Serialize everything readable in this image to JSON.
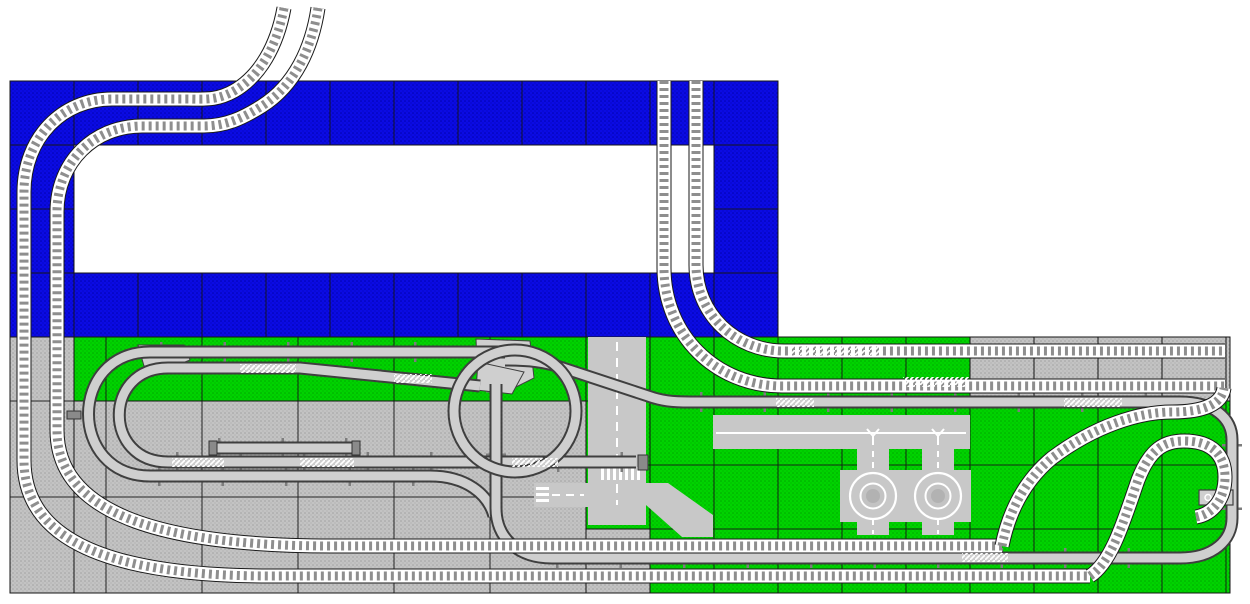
{
  "canvas": {
    "width": 1250,
    "height": 604,
    "background": "#ffffff"
  },
  "palette": {
    "baseplate_blue": "#0b0be4",
    "baseplate_blue_dot": "#0000a8",
    "baseplate_green": "#00d300",
    "baseplate_green_dot": "#00a300",
    "baseplate_gray": "#c3c3c3",
    "baseplate_gray_dot": "#9f9f9f",
    "road_gray": "#c8c8c8",
    "grid_line": "#151515",
    "rail_outline": "#1a1a1a",
    "rail_bed": "#ffffff",
    "rail_tie": "#8e8e8e",
    "mono_outline": "#3f3f3f",
    "mono_fill": "#cfcfcf",
    "mono_support": "#7d7d7d",
    "mono_cap": "#8a8a8a",
    "marking_white": "#ffffff"
  },
  "plates": [
    {
      "name": "blue-frame-top",
      "fill": "blue",
      "x": 10,
      "y": 81,
      "w": 768,
      "h": 64,
      "grid": {
        "ox": 10,
        "oy": 81,
        "cw": 64,
        "ch": 64
      }
    },
    {
      "name": "blue-frame-bottom",
      "fill": "blue",
      "x": 10,
      "y": 273,
      "w": 768,
      "h": 64,
      "grid": {
        "ox": 10,
        "oy": 81,
        "cw": 64,
        "ch": 64
      }
    },
    {
      "name": "blue-frame-left",
      "fill": "blue",
      "x": 10,
      "y": 145,
      "w": 64,
      "h": 128,
      "grid": {
        "ox": 10,
        "oy": 81,
        "cw": 64,
        "ch": 64
      }
    },
    {
      "name": "blue-frame-right",
      "fill": "blue",
      "x": 714,
      "y": 145,
      "w": 64,
      "h": 128,
      "grid": {
        "ox": 10,
        "oy": 81,
        "cw": 64,
        "ch": 64
      }
    },
    {
      "name": "green-band",
      "fill": "green",
      "x": 74,
      "y": 337,
      "w": 512,
      "h": 64,
      "grid": {
        "ox": 10,
        "oy": 337,
        "cw": 96,
        "ch": 96
      }
    },
    {
      "name": "road-column-plate",
      "fill": "green",
      "x": 586,
      "y": 337,
      "w": 64,
      "h": 192,
      "grid": {
        "ox": 586,
        "oy": 337,
        "cw": 64,
        "ch": 64
      }
    },
    {
      "name": "green-right",
      "fill": "green",
      "x": 650,
      "y": 337,
      "w": 580,
      "h": 256,
      "grid": {
        "ox": 650,
        "oy": 337,
        "cw": 64,
        "ch": 64
      }
    },
    {
      "name": "gray-left-column",
      "fill": "gray",
      "x": 10,
      "y": 337,
      "w": 64,
      "h": 256,
      "grid": {
        "ox": 10,
        "oy": 401,
        "cw": 96,
        "ch": 96
      }
    },
    {
      "name": "gray-main",
      "fill": "gray",
      "x": 74,
      "y": 401,
      "w": 512,
      "h": 192,
      "grid": {
        "ox": 10,
        "oy": 401,
        "cw": 96,
        "ch": 96
      }
    },
    {
      "name": "gray-under-road",
      "fill": "gray",
      "x": 586,
      "y": 529,
      "w": 64,
      "h": 64,
      "grid": {
        "ox": 586,
        "oy": 529,
        "cw": 64,
        "ch": 64
      }
    },
    {
      "name": "gray-top-right",
      "fill": "gray",
      "x": 970,
      "y": 337,
      "w": 260,
      "h": 64,
      "grid": {
        "ox": 970,
        "oy": 337,
        "cw": 64,
        "ch": 64
      }
    }
  ],
  "roads": {
    "rects": [
      {
        "name": "road-vertical-strip",
        "x": 588,
        "y": 337,
        "w": 58,
        "h": 188
      },
      {
        "name": "road-west-stub",
        "x": 534,
        "y": 483,
        "w": 58,
        "h": 24
      },
      {
        "name": "road-green-band",
        "x": 713,
        "y": 415,
        "w": 257,
        "h": 34
      }
    ],
    "polygons": [
      {
        "name": "road-diagonal",
        "points": "646,483 668,483 713,515 713,537 682,537 646,505"
      }
    ],
    "roundabouts": {
      "centers": [
        [
          873,
          496
        ],
        [
          938,
          496
        ]
      ],
      "arm_v": {
        "w": 32,
        "y": 449,
        "h": 86
      },
      "arm_h": {
        "w": 66,
        "y": 470,
        "h": 52
      },
      "disc_r": 28,
      "outer_ring_r": 23,
      "inner_ring_r": 12.5,
      "hub_r": 7
    },
    "crosswalks": [
      {
        "name": "crosswalk-vertical-road",
        "x": 600,
        "y": 467,
        "w": 42,
        "h": 13,
        "pattern": "zebraV"
      },
      {
        "name": "crosswalk-west-stub",
        "x": 536,
        "y": 485,
        "w": 13,
        "h": 20,
        "pattern": "zebraH"
      }
    ],
    "lines": [
      {
        "name": "centerline-v",
        "d": "M617,342 L617,464",
        "dash": "9 7"
      },
      {
        "name": "centerline-v-lower",
        "d": "M617,484 L617,505",
        "dash": "9 7"
      },
      {
        "name": "centerline-stub",
        "d": "M552,495 L584,495",
        "dash": "8 6"
      },
      {
        "name": "centerline-greenband",
        "d": "M716,433 L966,433",
        "dash": ""
      },
      {
        "name": "roundabout1-dash-up",
        "d": "M873,451 L873,474",
        "dash": "6 5"
      },
      {
        "name": "roundabout1-dash-down",
        "d": "M873,519 L873,534",
        "dash": "6 5"
      },
      {
        "name": "roundabout2-dash-up",
        "d": "M938,451 L938,474",
        "dash": "6 5"
      },
      {
        "name": "roundabout2-dash-down",
        "d": "M938,519 L938,534",
        "dash": "6 5"
      }
    ],
    "y_arrows": [
      [
        873,
        429
      ],
      [
        938,
        429
      ]
    ]
  },
  "monorail": {
    "lines": [
      {
        "name": "monorail-oval-outer",
        "d": "M505,352 L150,352 C68,352 68,476 150,476 L430,476 C466,476 488,494 494,516"
      },
      {
        "name": "monorail-oval-inner",
        "d": "M480,386 L300,368 L168,368 C103,368 103,462 168,462 L636,462"
      },
      {
        "name": "monorail-siding",
        "d": "M212,448 L358,448"
      },
      {
        "name": "monorail-main-loop",
        "d": "M505,360 C530,360 545,362 560,367 L648,396 C662,401 672,402 690,402 L1180,402 C1214,402 1232,418 1232,440 L1232,518 C1232,540 1214,558 1180,558 L552,558 C518,558 496,538 496,508 L496,384"
      }
    ],
    "circle": {
      "cx": 515,
      "cy": 411,
      "r": 61
    },
    "switches": [
      {
        "name": "monorail-switch-west",
        "points": "138,345 184,345 190,360 170,368 144,366"
      },
      {
        "name": "monorail-switch-north-a",
        "points": "476,339 530,341 534,378 510,390 478,386"
      },
      {
        "name": "monorail-switch-north-b",
        "points": "478,362 524,372 512,394 476,390"
      }
    ],
    "supports": [
      [
        160,
        352,
        498,
        352
      ],
      [
        176,
        462,
        630,
        462
      ],
      [
        158,
        476,
        425,
        476
      ],
      [
        218,
        448,
        352,
        448
      ],
      [
        700,
        402,
        1176,
        402
      ],
      [
        556,
        558,
        1176,
        558
      ],
      [
        496,
        390,
        496,
        506
      ],
      [
        1232,
        444,
        1232,
        514
      ]
    ],
    "caps": [
      [
        638,
        455,
        10,
        15
      ],
      [
        352,
        441,
        8,
        14
      ],
      [
        209,
        441,
        8,
        14
      ],
      [
        67,
        411,
        14,
        8
      ]
    ],
    "station": {
      "x": 1199,
      "y": 490,
      "w": 34,
      "h": 15
    }
  },
  "train_tracks": [
    {
      "name": "track-west-outer",
      "d": "M284,8 C277,46 260,76 234,91 C216,101 204,99 186,99 L112,99 C62,99 24,138 24,192 L24,460 C24,532 92,576 270,576 L1090,576"
    },
    {
      "name": "track-west-inner",
      "d": "M318,8 C312,48 295,85 262,106 C243,118 226,126 204,126 L142,126 C94,126 57,162 57,212 L57,430 C57,510 152,546 332,546 L1002,546"
    },
    {
      "name": "track-north-left",
      "d": "M664,81 L664,268 C664,335 716,386 782,386 L1225,386"
    },
    {
      "name": "track-north-right",
      "d": "M696,81 L696,265 C696,314 735,351 784,351 L1225,351"
    },
    {
      "name": "track-east-loop-a",
      "d": "M1002,546 C1010,506 1028,478 1052,458 C1096,425 1140,412 1172,412 C1204,412 1222,404 1224,388"
    },
    {
      "name": "track-east-loop-b",
      "d": "M1090,576 C1112,562 1124,520 1138,480 C1150,449 1164,441 1184,441 C1212,441 1225,455 1225,477 C1225,499 1213,514 1196,517"
    }
  ],
  "chevrons": [
    [
      788,
      346,
      95,
      10
    ],
    [
      903,
      377,
      66,
      10
    ],
    [
      240,
      364,
      56,
      9
    ],
    [
      394,
      374,
      38,
      9
    ],
    [
      172,
      458,
      52,
      9
    ],
    [
      300,
      458,
      54,
      9
    ],
    [
      512,
      458,
      46,
      9
    ],
    [
      776,
      398,
      38,
      9
    ],
    [
      1064,
      398,
      58,
      9
    ],
    [
      962,
      553,
      46,
      9
    ]
  ]
}
